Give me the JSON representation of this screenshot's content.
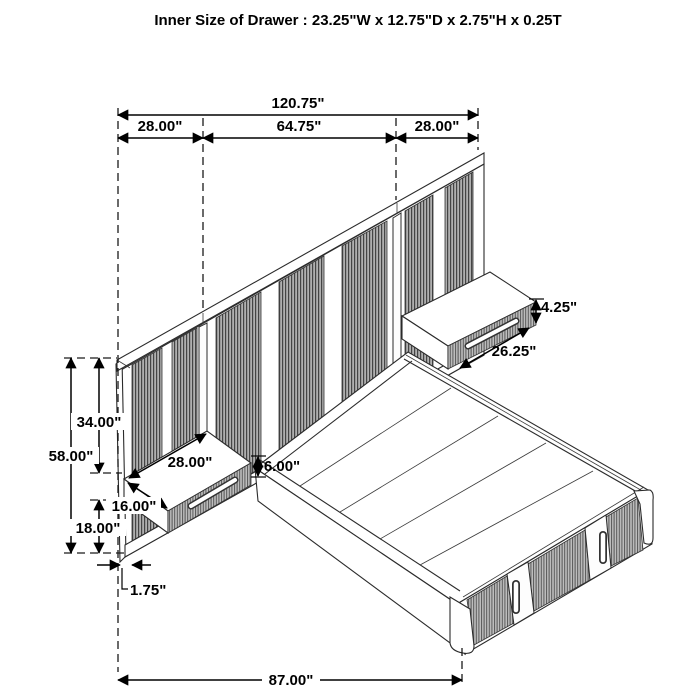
{
  "title": "Inner Size of Drawer : 23.25\"W x 12.75\"D x 2.75\"H x 0.25T",
  "diagram": {
    "type": "isometric-furniture-dimension-drawing",
    "subject": "wall-panel headboard bed with floating nightstands and storage platform"
  },
  "dims": {
    "total_width": "120.75\"",
    "left_panel_width": "28.00\"",
    "center_panel_width": "64.75\"",
    "right_panel_width": "28.00\"",
    "headboard_height": "58.00\"",
    "top_to_shelf": "34.00\"",
    "shelf_to_bottom": "18.00\"",
    "shelf_depth": "16.00\"",
    "left_shelf_width": "28.00\"",
    "shelf_height": "6.00\"",
    "panel_thickness": "1.75\"",
    "right_shelf_height": "4.25\"",
    "right_shelf_width": "26.25\"",
    "bed_length": "87.00\""
  }
}
